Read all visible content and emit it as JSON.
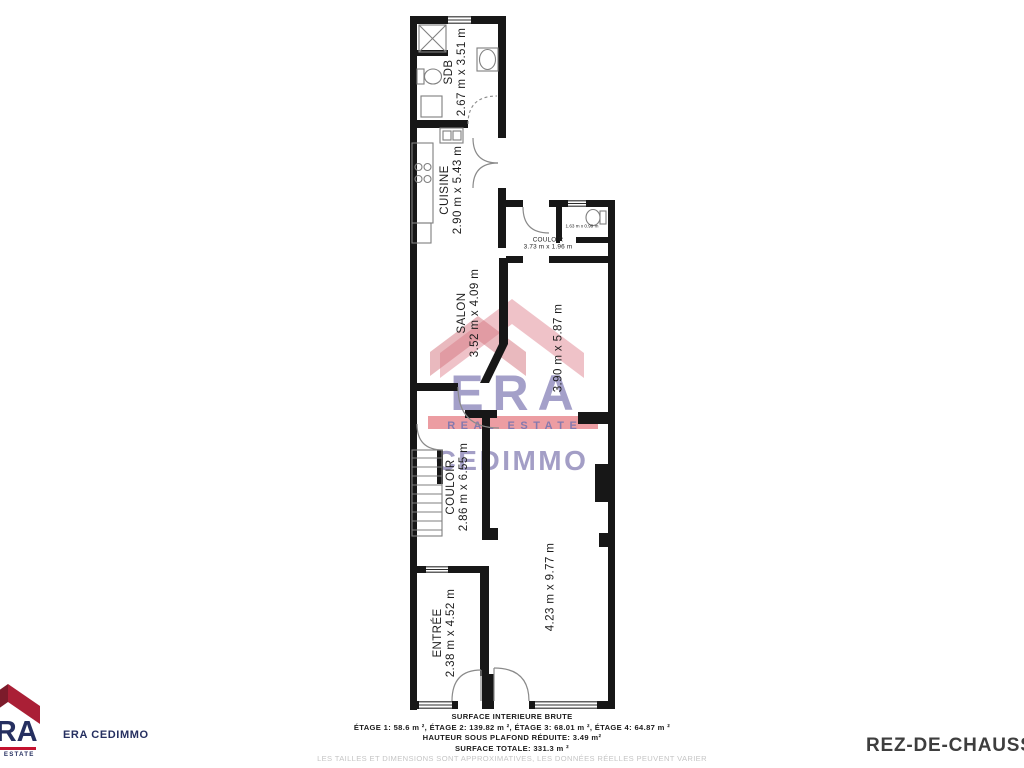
{
  "page_title": "REZ-DE-CHAUSSÉE",
  "floor_plan": {
    "rooms": {
      "sdb": {
        "name": "SDB",
        "dims": "2.67 m x 3.51 m"
      },
      "cuisine": {
        "name": "CUISINE",
        "dims": "2.90 m x 5.43 m"
      },
      "couloir_haut": {
        "name": "COULOIR",
        "dims": "3.73 m x 1.96 m"
      },
      "wc": {
        "dims": "1.63 m x 0.99 m"
      },
      "salon": {
        "name": "SALON",
        "dims": "3.52 m x 4.09 m"
      },
      "piece_arriere": {
        "dims": "3.90 m x 5.87 m"
      },
      "couloir_bas": {
        "name": "COULOIR",
        "dims": "2.86 m x 6.55 m"
      },
      "entree": {
        "name": "ENTRÉE",
        "dims": "2.38 m x 4.52 m"
      },
      "grande_piece": {
        "dims": "4.23 m x 9.77 m"
      }
    }
  },
  "watermark": {
    "era": "ERA",
    "real_estate": "REAL ESTATE",
    "agency": "CEDIMMO"
  },
  "logo": {
    "era": "ERA",
    "real_estate": "REAL ESTATE",
    "agency_label": "ERA CEDIMMO"
  },
  "footer": {
    "title": "SURFACE INTERIEURE BRUTE",
    "etages": "ÉTAGE 1: 58.6 m ², ÉTAGE 2: 139.82 m ², ÉTAGE 3: 68.01 m ², ÉTAGE 4: 64.87 m ²",
    "hauteur": "HAUTEUR SOUS PLAFOND RÉDUITE: 3.49 m²",
    "total": "SURFACE TOTALE: 331.3 m ²",
    "disclaimer": "LES TAILLES ET DIMENSIONS SONT APPROXIMATIVES, LES DONNÉES RÉELLES PEUVENT VARIER"
  },
  "colors": {
    "wall": "#171717",
    "fixture": "#7f7f7f",
    "label": "#1d1d1d",
    "watermark_pink": "#e59aa4",
    "watermark_pink_dark": "#d4737e",
    "watermark_purple": "#827cb5",
    "watermark_red": "#e4737a",
    "watermark_letters": "#7d77b0",
    "cedimmo": "#8d87b8",
    "logo_navy": "#252f60",
    "logo_red": "#c41230",
    "roof_dark": "#7c1b2b",
    "roof_bright": "#aa1f36",
    "title": "#3e3e3e",
    "footer_text": "#1b1b1b",
    "disclaimer": "#c5c5c5"
  }
}
